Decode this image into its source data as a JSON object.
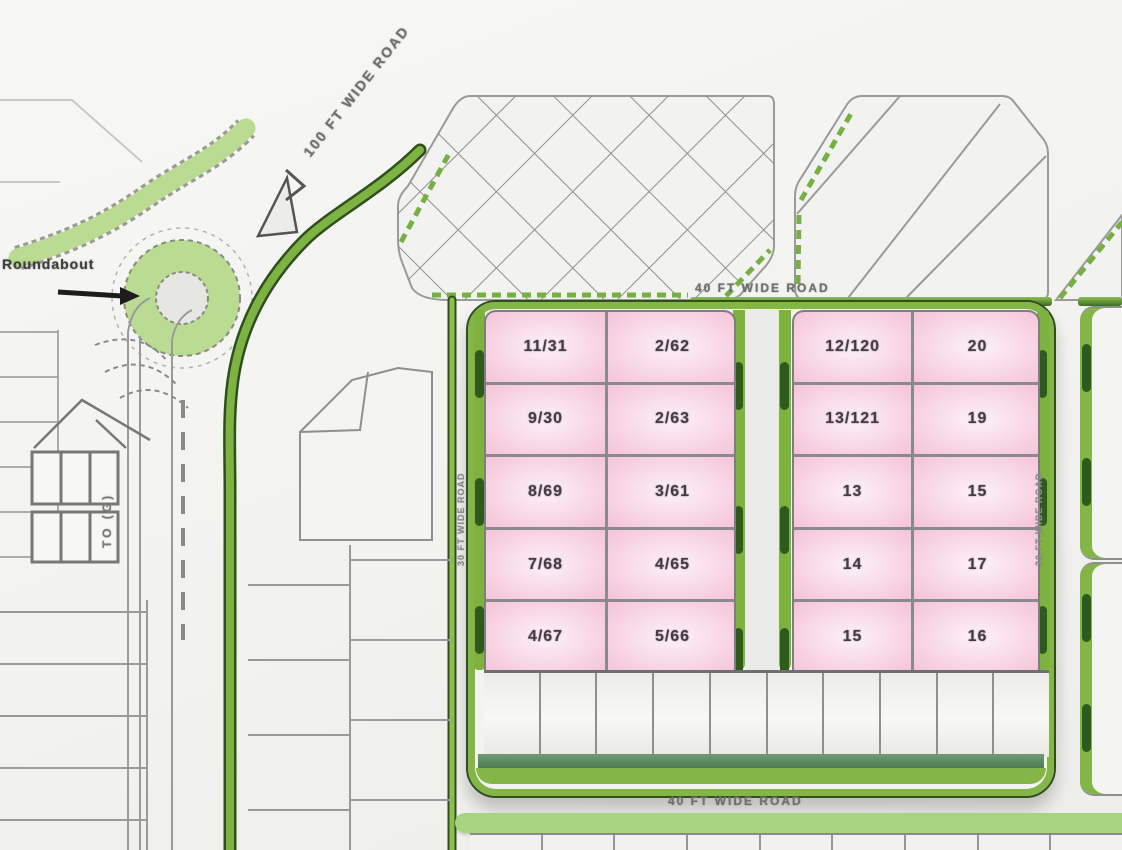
{
  "palette": {
    "bright_green": "#7cb342",
    "light_green": "#b9dc92",
    "dark_green_hedge": "#2e5b1d",
    "teal_strip": "#47774e",
    "pink_lot_edge": "#f5c3d9",
    "pink_lot_center": "#fdf2f7",
    "lot_line_grey": "#8a8a8a",
    "label_grey": "#6e6e6e",
    "number_color": "#463a47"
  },
  "labels": {
    "roundabout": "Roundabout",
    "diagonal_road": "100 FT WIDE ROAD",
    "top_road": "40 FT WIDE ROAD",
    "bottom_road": "40 FT WIDE ROAD",
    "left_block_road": "30 FT WIDE ROAD",
    "center_block_road": "30 FT WIDE ROAD",
    "destination": "TO (G)"
  },
  "icons": {
    "north_arrow": "triangle-north-arrow",
    "roundabout_pointer": "arrow-right"
  },
  "blocks": {
    "left_residential": {
      "rows": [
        [
          "11/31",
          "2/62"
        ],
        [
          "9/30",
          "2/63"
        ],
        [
          "8/69",
          "3/61"
        ],
        [
          "7/68",
          "4/65"
        ],
        [
          "4/67",
          "5/66"
        ]
      ]
    },
    "right_residential": {
      "rows": [
        [
          "12/120",
          "20"
        ],
        [
          "13/121",
          "19"
        ],
        [
          "13",
          "15"
        ],
        [
          "14",
          "17"
        ],
        [
          "15",
          "16"
        ]
      ]
    }
  }
}
